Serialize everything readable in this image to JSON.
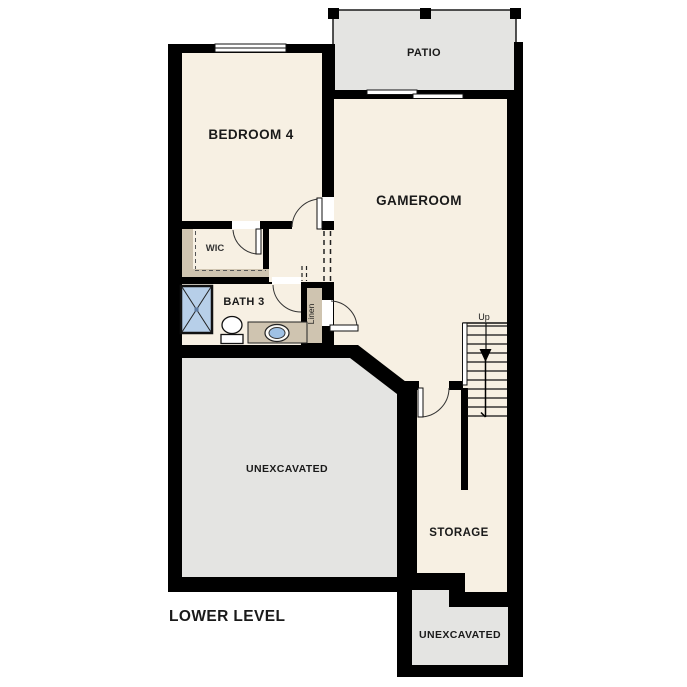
{
  "plan_title": "LOWER LEVEL",
  "rooms": {
    "bedroom4": {
      "label": "BEDROOM 4"
    },
    "patio": {
      "label": "PATIO"
    },
    "gameroom": {
      "label": "GAMEROOM"
    },
    "wic": {
      "label": "WIC"
    },
    "bath3": {
      "label": "BATH 3"
    },
    "linen": {
      "label": "Linen"
    },
    "unexcavated_main": {
      "label": "UNEXCAVATED"
    },
    "storage": {
      "label": "STORAGE"
    },
    "unexcavated_lower": {
      "label": "UNEXCAVATED"
    }
  },
  "stairs": {
    "label": "Up",
    "tread_count": 11,
    "arrow_direction": "down"
  },
  "colors": {
    "wall": "#000000",
    "room_fill": "#f7f0e3",
    "exterior_fill": "#e4e4e2",
    "casework_fill": "#cfc4b0",
    "shower_blue": "#b7cfe9",
    "sink_blue": "#9fc1e4"
  }
}
